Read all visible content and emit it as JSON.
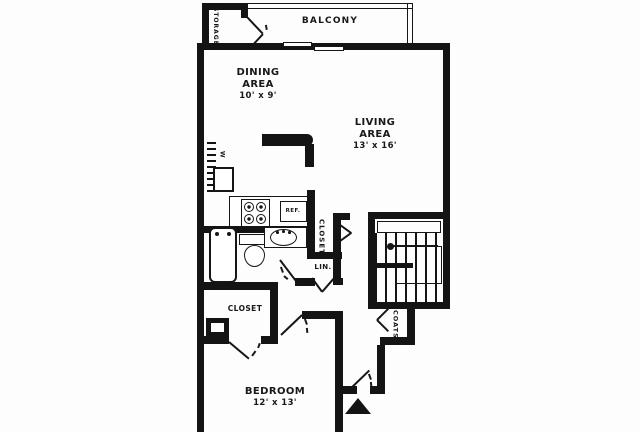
{
  "rooms": {
    "balcony": {
      "label": "BALCONY"
    },
    "storage": {
      "label": "STORAGE"
    },
    "dining": {
      "name": "DINING",
      "name2": "AREA",
      "dims": "10' x 9'"
    },
    "living": {
      "name": "LIVING",
      "name2": "AREA",
      "dims": "13' x 16'"
    },
    "bedroom": {
      "name": "BEDROOM",
      "dims": "12' x 13'"
    },
    "bedroom_closet": {
      "label": "CLOSET"
    },
    "hall_closet": {
      "label": "CLOSET"
    },
    "linen_closet": {
      "label": "LIN."
    },
    "coat_closet": {
      "label": "COATS"
    }
  },
  "fixtures": {
    "refrigerator": "REF.",
    "washer": "W"
  },
  "colors": {
    "wall": "#141414",
    "background": "#ffffff",
    "text": "#181818"
  }
}
